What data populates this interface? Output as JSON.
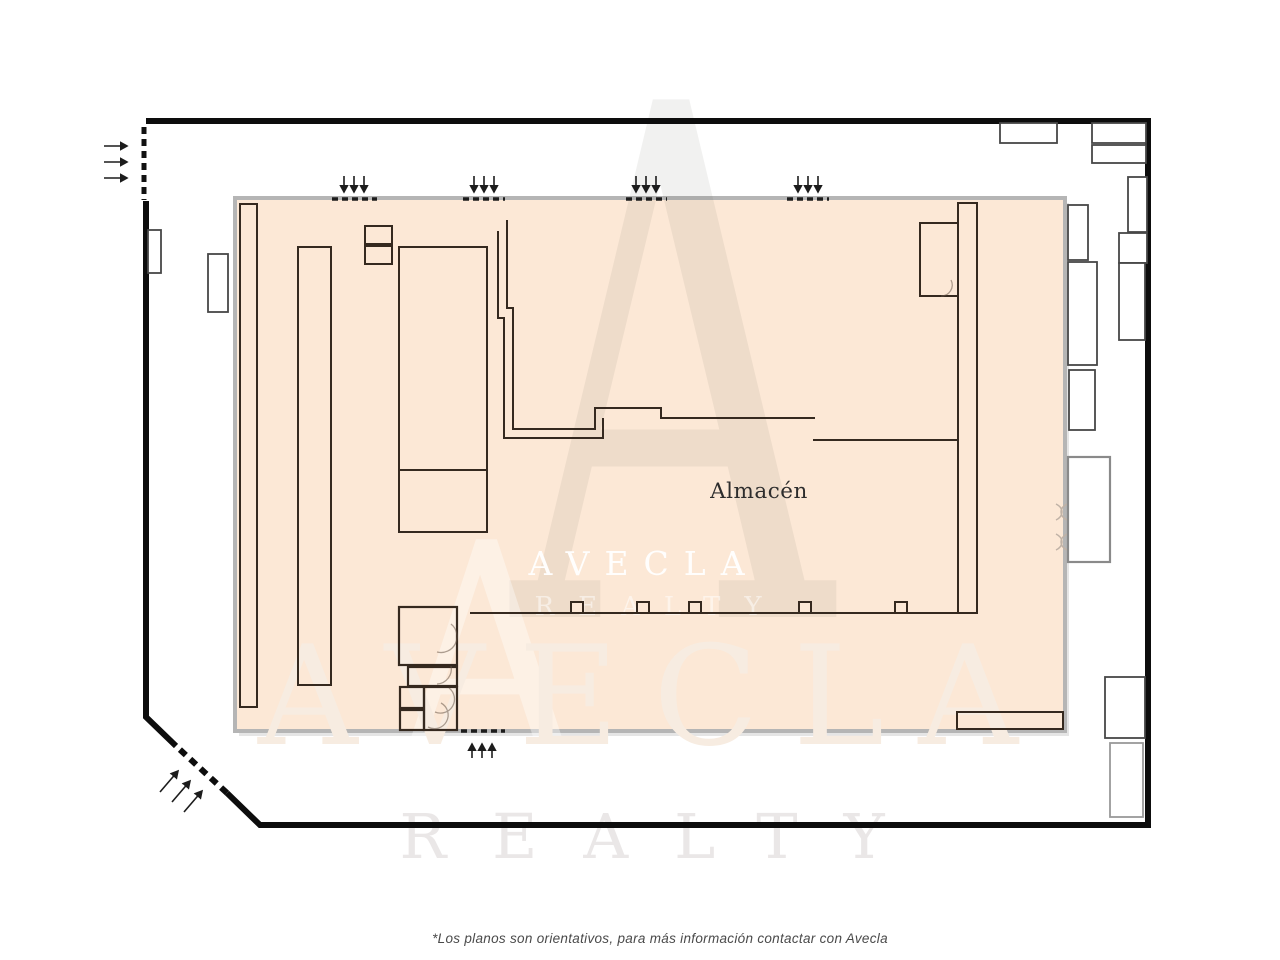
{
  "plan": {
    "room_label": "Almacén",
    "footnote": "*Los planos son orientativos, para más información contactar con Avecla"
  },
  "brand": {
    "monogram": "A",
    "name": "AVECLA",
    "tagline": "REALTY"
  },
  "colors": {
    "floor_fill": "#FCE8D6",
    "floor_border": "#B5B5B5",
    "outer_wall": "#0D0D0D",
    "inner_line": "#35291F",
    "opening_dash": "#1C1C1C",
    "watermark_gray": "#F0EFEE"
  }
}
